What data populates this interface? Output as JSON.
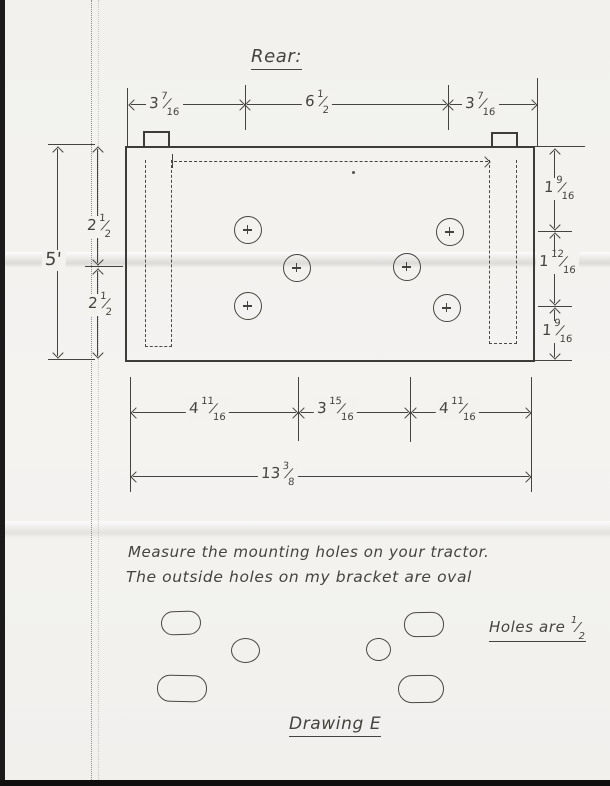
{
  "colors": {
    "paper": "#f3f2ef",
    "pencil": "#45433f",
    "scan_edge": "#1b1b1b"
  },
  "title": {
    "text": "Rear:"
  },
  "notes": {
    "line1": "Measure the mounting holes on your tractor.",
    "line2": "The outside holes on my bracket are oval"
  },
  "holes_note": {
    "prefix": "Holes are",
    "fraction": {
      "num": "1",
      "den": "2"
    }
  },
  "drawing_label": {
    "text": "Drawing E"
  },
  "dimensions": {
    "top": [
      {
        "whole": "3",
        "num": "7",
        "den": "16"
      },
      {
        "whole": "6",
        "num": "1",
        "den": "2"
      },
      {
        "whole": "3",
        "num": "7",
        "den": "16"
      }
    ],
    "left_overall": {
      "whole": "5'"
    },
    "left_segments": [
      {
        "whole": "2",
        "num": "1",
        "den": "2"
      },
      {
        "whole": "2",
        "num": "1",
        "den": "2"
      }
    ],
    "right_segments": [
      {
        "whole": "1",
        "num": "9",
        "den": "16"
      },
      {
        "whole": "1",
        "num": "12",
        "den": "16"
      },
      {
        "whole": "1",
        "num": "9",
        "den": "16"
      }
    ],
    "bottom_segments": [
      {
        "whole": "4",
        "num": "11",
        "den": "16"
      },
      {
        "whole": "3",
        "num": "15",
        "den": "16"
      },
      {
        "whole": "4",
        "num": "11",
        "den": "16"
      }
    ],
    "bottom_overall": {
      "whole": "13",
      "num": "3",
      "den": "8"
    }
  }
}
